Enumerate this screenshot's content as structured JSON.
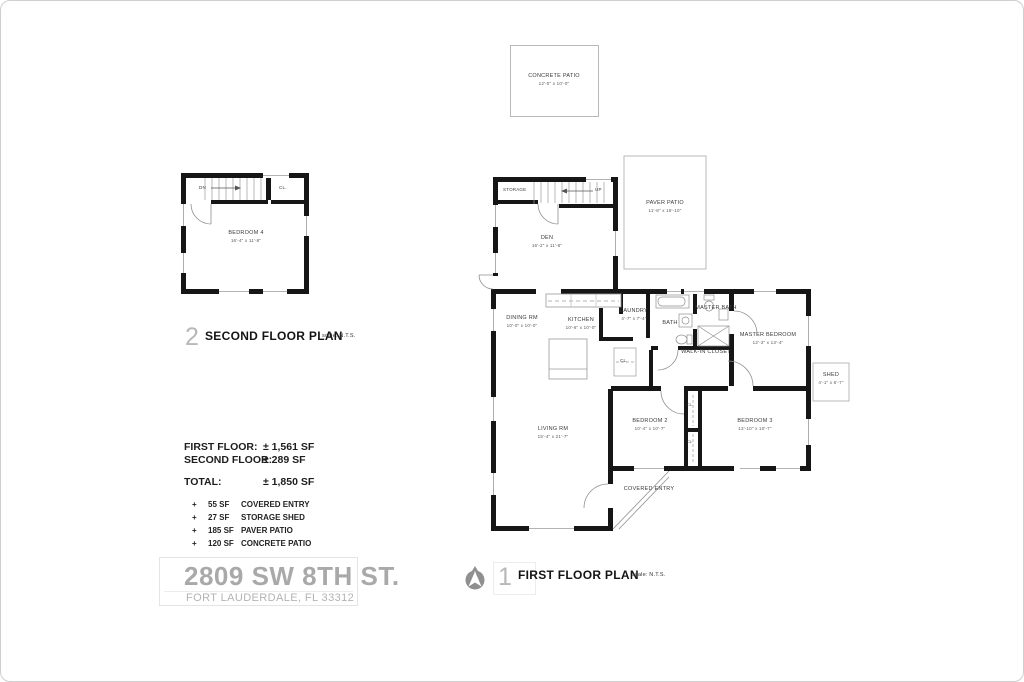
{
  "patio": {
    "name": "CONCRETE PATIO",
    "dims": "12'-0\" x 10'-0\""
  },
  "second_floor": {
    "stairs": "DN",
    "closet": "CL.",
    "bedroom4": {
      "name": "BEDROOM 4",
      "dims": "16'-4\" x 11'-8\""
    },
    "title": {
      "number": "2",
      "label": "SECOND FLOOR PLAN",
      "scale": "scale: N.T.S."
    }
  },
  "first_floor": {
    "storage": "STORAGE",
    "stairs": "UP",
    "den": {
      "name": "DEN",
      "dims": "16'-2\" x 11'-8\""
    },
    "paver_patio": {
      "name": "PAVER PATIO",
      "dims": "11'-8\" x 15'-10\""
    },
    "dining": {
      "name": "DINING RM",
      "dims": "10'-0\" x 10'-0\""
    },
    "kitchen": {
      "name": "KITCHEN",
      "dims": "10'-6\" x 10'-0\""
    },
    "laundry": {
      "name": "LAUNDRY",
      "dims": "4'-7\" x 7'-4\""
    },
    "bath": {
      "name": "BATH"
    },
    "master_bath": {
      "line1": "MASTER",
      "line2": "BATH"
    },
    "master_bedroom": {
      "name": "MASTER BEDROOM",
      "dims": "12'-2\" x 13'-4\""
    },
    "walkin": {
      "line1": "WALK-IN",
      "line2": "CLOSET"
    },
    "hall_closet": "CL.",
    "closet_a": "CL",
    "closet_b": "CL",
    "living": {
      "name": "LIVING RM",
      "dims": "15'-4\" x 21'-7\""
    },
    "bedroom2": {
      "name": "BEDROOM 2",
      "dims": "10'-4\" x 10'-7\""
    },
    "bedroom3": {
      "name": "BEDROOM 3",
      "dims": "13'-10\" x 10'-7\""
    },
    "shed": {
      "name": "SHED",
      "dims": "4'-1\" x 6'-7\""
    },
    "covered_entry": {
      "line1": "COVERED",
      "line2": "ENTRY"
    },
    "title": {
      "number": "1",
      "label": "FIRST FLOOR PLAN",
      "scale": "scale: N.T.S."
    }
  },
  "areas": {
    "rows": [
      {
        "label": "FIRST FLOOR:",
        "value": "± 1,561 SF"
      },
      {
        "label": "SECOND FLOOR:",
        "value": "± 289 SF"
      }
    ],
    "total": {
      "label": "TOTAL:",
      "value": "± 1,850 SF"
    },
    "extras": [
      {
        "bullet": "+",
        "sf": "55 SF",
        "label": "COVERED ENTRY"
      },
      {
        "bullet": "+",
        "sf": "27 SF",
        "label": "STORAGE SHED"
      },
      {
        "bullet": "+",
        "sf": "185 SF",
        "label": "PAVER PATIO"
      },
      {
        "bullet": "+",
        "sf": "120 SF",
        "label": "CONCRETE PATIO"
      }
    ]
  },
  "address": {
    "line1": "2809 SW 8TH ST.",
    "line2": "FORT LAUDERDALE, FL 33312"
  },
  "colors": {
    "wall": "#161616",
    "thin_line": "#b9b9b9",
    "gray_text": "#a9a9a9",
    "number_gray": "#b8b8b8"
  }
}
